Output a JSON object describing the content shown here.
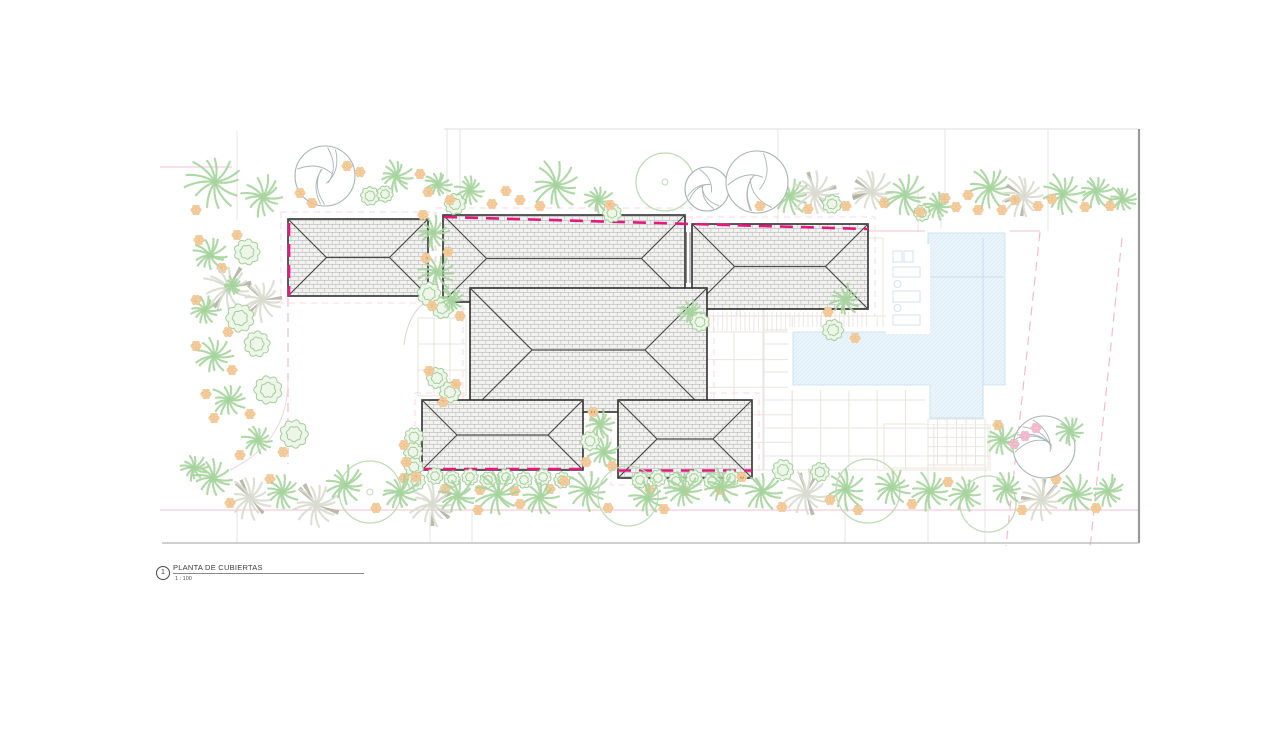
{
  "title_block": {
    "number": "1",
    "title": "PLANTA DE CUBIERTAS",
    "scale": "1 : 100"
  },
  "colors": {
    "magenta": "#e3197d",
    "pink_solid": "#f2c0cd",
    "pink_dash": "#f3bccb",
    "eave_pink": "#f7d4de",
    "faint": "#e4e4e4",
    "sheet_top": "#dcdcdc",
    "sheet_right": "#9a9a9a",
    "sheet_bottom": "#b3b3b3",
    "roof_bg": "#f2f2f1",
    "roof_line": "#b8b8b8",
    "roof_edge": "#303030",
    "roof_hip": "#4a4a4a",
    "chimney": "#777777",
    "grid": "#e9e6df",
    "terrace": "#ece5da",
    "deck": "#e7e4db",
    "pool_fill": "#e9f4fb",
    "pool_hatch": "#d7e9f6",
    "pool_edge": "#cfe3f2",
    "pool_inner": "#c9deee",
    "lounger": "#d3e2ee",
    "palm": "#a6d49d",
    "palm_pale": "#d9dbd0",
    "palm_accent": "#a9a999",
    "bush": "#a2cd99",
    "bush_fill": "#eef6ea",
    "flower": "#f5cd9c",
    "flower_edge": "#eab57b",
    "flower_core": "#f0c189",
    "flower_pink": "#f3bed0",
    "flower_pink_edge": "#e8a2bd",
    "tree_gray": "#a7b5b3",
    "tree_green": "#c0dbb8"
  },
  "drawing": {
    "sheet_lines": [
      [
        444,
        129,
        1139,
        129,
        "sheet_top",
        1
      ],
      [
        1139,
        129,
        1139,
        543,
        "sheet_right",
        2.2
      ],
      [
        162,
        543,
        1139,
        543,
        "sheet_bottom",
        1.3
      ]
    ],
    "faint_vlines": [
      [
        237,
        131,
        220
      ],
      [
        447,
        129,
        216
      ],
      [
        460,
        129,
        216
      ],
      [
        778,
        129,
        230
      ],
      [
        918,
        192,
        232
      ],
      [
        941,
        192,
        232
      ],
      [
        945,
        129,
        192
      ],
      [
        1048,
        129,
        231
      ],
      [
        237,
        510,
        543
      ],
      [
        430,
        512,
        543
      ],
      [
        472,
        512,
        543
      ],
      [
        845,
        470,
        543
      ],
      [
        928,
        465,
        543
      ],
      [
        985,
        465,
        543
      ]
    ],
    "pink_solid_lines": [
      [
        160,
        510,
        1138,
        510
      ],
      [
        868,
        231,
        1040,
        231
      ],
      [
        160,
        167,
        232,
        167
      ]
    ],
    "pink_dashed_lines": [
      [
        288,
        298,
        288,
        464
      ],
      [
        1040,
        232,
        1006,
        546
      ],
      [
        1122,
        238,
        1090,
        548
      ]
    ],
    "faint_paths": [
      {
        "d": "M 288 380 Q 288 442 230 470",
        "c": "#f0d8dc"
      },
      {
        "d": "M 432 298 Q 408 310 404 345",
        "c": "#d9d9d2"
      }
    ],
    "terrace_rects": [
      [
        737,
        238,
        26,
        78
      ],
      [
        764,
        238,
        119,
        92
      ],
      [
        703,
        316,
        287,
        154
      ],
      [
        884,
        424,
        104,
        44
      ]
    ],
    "deck_hatch": [
      [
        700,
        312,
        168,
        19,
        4.5
      ],
      [
        770,
        296,
        98,
        14,
        4.5
      ]
    ],
    "grids": [
      [
        705,
        332,
        88,
        138,
        29,
        27.6
      ],
      [
        764,
        316,
        226,
        154,
        28.3,
        28
      ],
      [
        740,
        242,
        24,
        74,
        24,
        25
      ],
      [
        418,
        318,
        48,
        78,
        16,
        26
      ]
    ],
    "pool": {
      "points": "928,233 1005,233 1005,385 983,385 983,418 930,418 930,385 793,385 793,332 928,332",
      "white_pads": [
        [
          788,
          327,
          222,
          63
        ],
        [
          925,
          228,
          85,
          196
        ]
      ],
      "inner_lines": [
        [
          928,
          238,
          928,
          330
        ],
        [
          983,
          238,
          983,
          416
        ],
        [
          928,
          277,
          1003,
          277
        ]
      ]
    },
    "fine_grid": [
      928,
      419,
      57,
      46,
      9.5,
      9.2
    ],
    "lounger_zone": [
      886,
      244,
      44,
      90
    ],
    "loungers": {
      "rects": [
        [
          893,
          251,
          9,
          11
        ],
        [
          904,
          251,
          9,
          11
        ],
        [
          893,
          267,
          27,
          10
        ],
        [
          893,
          291,
          27,
          11
        ],
        [
          893,
          315,
          27,
          10
        ]
      ],
      "circles": [
        [
          897.5,
          284,
          3.5
        ],
        [
          897.5,
          308,
          3.5
        ]
      ]
    },
    "eave_outlines": [
      [
        281,
        212,
        154,
        91
      ],
      [
        436,
        208,
        256,
        101
      ],
      [
        685,
        217,
        190,
        99
      ],
      [
        463,
        281,
        251,
        138
      ],
      [
        415,
        393,
        175,
        84
      ],
      [
        611,
        393,
        148,
        92
      ]
    ],
    "roofs": [
      [
        288,
        219,
        140,
        77
      ],
      [
        443,
        215,
        242,
        87
      ],
      [
        692,
        224,
        176,
        85
      ],
      [
        470,
        288,
        237,
        124
      ],
      [
        422,
        400,
        161,
        70
      ],
      [
        618,
        400,
        134,
        78
      ]
    ],
    "chimney_lines": [
      [
        686.5,
        232,
        686.5,
        283
      ],
      [
        690,
        232,
        690,
        283
      ]
    ],
    "property_lines": [
      [
        289,
        223,
        289,
        296
      ],
      [
        444,
        217,
        868,
        229
      ],
      [
        422,
        469,
        584,
        469
      ],
      [
        618,
        470.5,
        752,
        470.5
      ]
    ],
    "plants": [
      [
        "p",
        215,
        182,
        30
      ],
      [
        "p",
        263,
        197,
        22
      ],
      [
        "p",
        396,
        176,
        17
      ],
      [
        "p",
        438,
        184,
        14
      ],
      [
        "p",
        470,
        190,
        15
      ],
      [
        "p",
        556,
        185,
        26
      ],
      [
        "p",
        598,
        200,
        15
      ],
      [
        "pp",
        772,
        172,
        14
      ],
      [
        "p",
        790,
        196,
        20
      ],
      [
        "pp",
        815,
        193,
        24
      ],
      [
        "pp",
        872,
        192,
        22
      ],
      [
        "p",
        905,
        195,
        22
      ],
      [
        "p",
        938,
        206,
        15
      ],
      [
        "p",
        990,
        188,
        22
      ],
      [
        "pp",
        1024,
        196,
        22
      ],
      [
        "p",
        1063,
        194,
        22
      ],
      [
        "p",
        1096,
        191,
        18
      ],
      [
        "p",
        1122,
        199,
        14
      ],
      [
        "tg",
        325,
        176,
        30
      ],
      [
        "tc",
        665,
        182,
        29
      ],
      [
        "tg",
        707,
        189,
        22
      ],
      [
        "tg",
        757,
        182,
        31
      ],
      [
        "b",
        370,
        196,
        8
      ],
      [
        "b",
        385,
        194,
        7
      ],
      [
        "b",
        455,
        204,
        9
      ],
      [
        "b",
        612,
        213,
        8
      ],
      [
        "b",
        832,
        204,
        8
      ],
      [
        "b",
        922,
        213,
        7
      ],
      [
        "f",
        300,
        193
      ],
      [
        "f",
        312,
        203
      ],
      [
        "f",
        347,
        166
      ],
      [
        "f",
        360,
        172
      ],
      [
        "f",
        420,
        174
      ],
      [
        "f",
        428,
        192
      ],
      [
        "f",
        450,
        200
      ],
      [
        "f",
        492,
        204
      ],
      [
        "f",
        506,
        191
      ],
      [
        "f",
        520,
        200
      ],
      [
        "f",
        540,
        206
      ],
      [
        "f",
        610,
        205
      ],
      [
        "f",
        760,
        206
      ],
      [
        "f",
        808,
        209
      ],
      [
        "f",
        846,
        206
      ],
      [
        "f",
        884,
        203
      ],
      [
        "f",
        920,
        212
      ],
      [
        "f",
        945,
        198
      ],
      [
        "f",
        956,
        207
      ],
      [
        "f",
        968,
        195
      ],
      [
        "f",
        978,
        210
      ],
      [
        "f",
        1002,
        210
      ],
      [
        "f",
        1015,
        200
      ],
      [
        "f",
        1038,
        206
      ],
      [
        "f",
        1052,
        199
      ],
      [
        "f",
        1085,
        207
      ],
      [
        "f",
        1110,
        206
      ],
      [
        "f",
        196,
        210
      ],
      [
        "p",
        210,
        255,
        18
      ],
      [
        "b",
        247,
        252,
        11
      ],
      [
        "f",
        199,
        240
      ],
      [
        "f",
        222,
        268
      ],
      [
        "f",
        237,
        235
      ],
      [
        "pp",
        228,
        288,
        26
      ],
      [
        "pp",
        262,
        300,
        22
      ],
      [
        "p",
        233,
        286,
        10
      ],
      [
        "p",
        205,
        310,
        16
      ],
      [
        "b",
        240,
        318,
        12
      ],
      [
        "b",
        257,
        344,
        11
      ],
      [
        "f",
        196,
        300
      ],
      [
        "f",
        228,
        332
      ],
      [
        "p",
        214,
        356,
        19
      ],
      [
        "f",
        196,
        346
      ],
      [
        "f",
        232,
        370
      ],
      [
        "b",
        268,
        390,
        12
      ],
      [
        "p",
        229,
        400,
        18
      ],
      [
        "f",
        206,
        394
      ],
      [
        "f",
        250,
        414
      ],
      [
        "f",
        214,
        418
      ],
      [
        "b",
        294,
        434,
        12
      ],
      [
        "p",
        258,
        440,
        16
      ],
      [
        "f",
        283,
        452
      ],
      [
        "f",
        240,
        455
      ],
      [
        "p",
        194,
        468,
        14
      ],
      [
        "p",
        433,
        233,
        17
      ],
      [
        "p",
        437,
        272,
        19
      ],
      [
        "b",
        429,
        294,
        10
      ],
      [
        "f",
        423,
        215
      ],
      [
        "f",
        448,
        252
      ],
      [
        "f",
        426,
        258
      ],
      [
        "b",
        442,
        308,
        9
      ],
      [
        "p",
        452,
        300,
        13
      ],
      [
        "f",
        432,
        306
      ],
      [
        "f",
        460,
        316
      ],
      [
        "b",
        437,
        378,
        9
      ],
      [
        "b",
        450,
        392,
        9
      ],
      [
        "f",
        429,
        371
      ],
      [
        "f",
        443,
        402
      ],
      [
        "f",
        456,
        384
      ],
      [
        "p",
        690,
        312,
        13
      ],
      [
        "b",
        700,
        322,
        8
      ],
      [
        "p",
        845,
        300,
        16
      ],
      [
        "b",
        833,
        330,
        9
      ],
      [
        "f",
        855,
        338
      ],
      [
        "f",
        828,
        312
      ],
      [
        "b",
        414,
        437,
        8
      ],
      [
        "b",
        413,
        452,
        8
      ],
      [
        "b",
        414,
        467,
        8
      ],
      [
        "b",
        416,
        481,
        8
      ],
      [
        "f",
        404,
        445
      ],
      [
        "f",
        406,
        462
      ],
      [
        "f",
        404,
        478
      ],
      [
        "b",
        435,
        476,
        7
      ],
      [
        "b",
        452,
        479,
        7
      ],
      [
        "b",
        470,
        477,
        7
      ],
      [
        "b",
        488,
        480,
        7
      ],
      [
        "b",
        506,
        477,
        7
      ],
      [
        "b",
        524,
        480,
        7
      ],
      [
        "b",
        543,
        477,
        7
      ],
      [
        "b",
        562,
        480,
        7
      ],
      [
        "f",
        445,
        489
      ],
      [
        "f",
        480,
        490
      ],
      [
        "f",
        515,
        491
      ],
      [
        "f",
        550,
        489
      ],
      [
        "b",
        640,
        480,
        7
      ],
      [
        "b",
        658,
        478,
        7
      ],
      [
        "b",
        676,
        481,
        7
      ],
      [
        "b",
        694,
        478,
        7
      ],
      [
        "b",
        712,
        481,
        7
      ],
      [
        "b",
        731,
        478,
        7
      ],
      [
        "f",
        650,
        490
      ],
      [
        "f",
        685,
        491
      ],
      [
        "f",
        720,
        490
      ],
      [
        "p",
        600,
        424,
        15
      ],
      [
        "p",
        604,
        452,
        17
      ],
      [
        "b",
        590,
        441,
        8
      ],
      [
        "f",
        593,
        412
      ],
      [
        "f",
        612,
        466
      ],
      [
        "f",
        586,
        462
      ],
      [
        "p",
        213,
        478,
        19
      ],
      [
        "pp",
        250,
        498,
        22
      ],
      [
        "f",
        230,
        503
      ],
      [
        "f",
        270,
        479
      ],
      [
        "p",
        282,
        492,
        18
      ],
      [
        "pp",
        316,
        505,
        26
      ],
      [
        "tc",
        370,
        492,
        31
      ],
      [
        "p",
        345,
        485,
        20
      ],
      [
        "p",
        400,
        493,
        20
      ],
      [
        "f",
        376,
        508
      ],
      [
        "f",
        416,
        477
      ],
      [
        "pp",
        432,
        504,
        24
      ],
      [
        "p",
        458,
        496,
        20
      ],
      [
        "p",
        498,
        494,
        23
      ],
      [
        "f",
        520,
        504
      ],
      [
        "f",
        478,
        510
      ],
      [
        "p",
        540,
        497,
        19
      ],
      [
        "p",
        588,
        491,
        22
      ],
      [
        "f",
        564,
        481
      ],
      [
        "f",
        608,
        508
      ],
      [
        "tn",
        628,
        496,
        30
      ],
      [
        "p",
        648,
        498,
        19
      ],
      [
        "p",
        684,
        491,
        21
      ],
      [
        "f",
        664,
        509
      ],
      [
        "p",
        722,
        487,
        19
      ],
      [
        "p",
        762,
        491,
        21
      ],
      [
        "f",
        742,
        477
      ],
      [
        "f",
        782,
        507
      ],
      [
        "pp",
        806,
        494,
        24
      ],
      [
        "b",
        783,
        470,
        9
      ],
      [
        "b",
        820,
        472,
        8
      ],
      [
        "p",
        846,
        489,
        21
      ],
      [
        "tn",
        868,
        491,
        32
      ],
      [
        "p",
        892,
        487,
        19
      ],
      [
        "f",
        830,
        500
      ],
      [
        "f",
        858,
        510
      ],
      [
        "p",
        930,
        491,
        21
      ],
      [
        "f",
        912,
        504
      ],
      [
        "f",
        948,
        482
      ],
      [
        "tn",
        988,
        504,
        28
      ],
      [
        "p",
        966,
        494,
        19
      ],
      [
        "p",
        1006,
        489,
        17
      ],
      [
        "pp",
        1042,
        500,
        23
      ],
      [
        "p",
        1076,
        494,
        21
      ],
      [
        "f",
        1056,
        479
      ],
      [
        "f",
        1096,
        508
      ],
      [
        "f",
        1022,
        510
      ],
      [
        "p",
        1108,
        491,
        17
      ],
      [
        "tg",
        1044,
        447,
        31
      ],
      [
        "p",
        1002,
        440,
        17
      ],
      [
        "p",
        1070,
        431,
        15
      ],
      [
        "fp",
        1025,
        436
      ],
      [
        "fp",
        1036,
        428
      ],
      [
        "fp",
        1014,
        444
      ],
      [
        "f",
        998,
        425
      ]
    ]
  }
}
